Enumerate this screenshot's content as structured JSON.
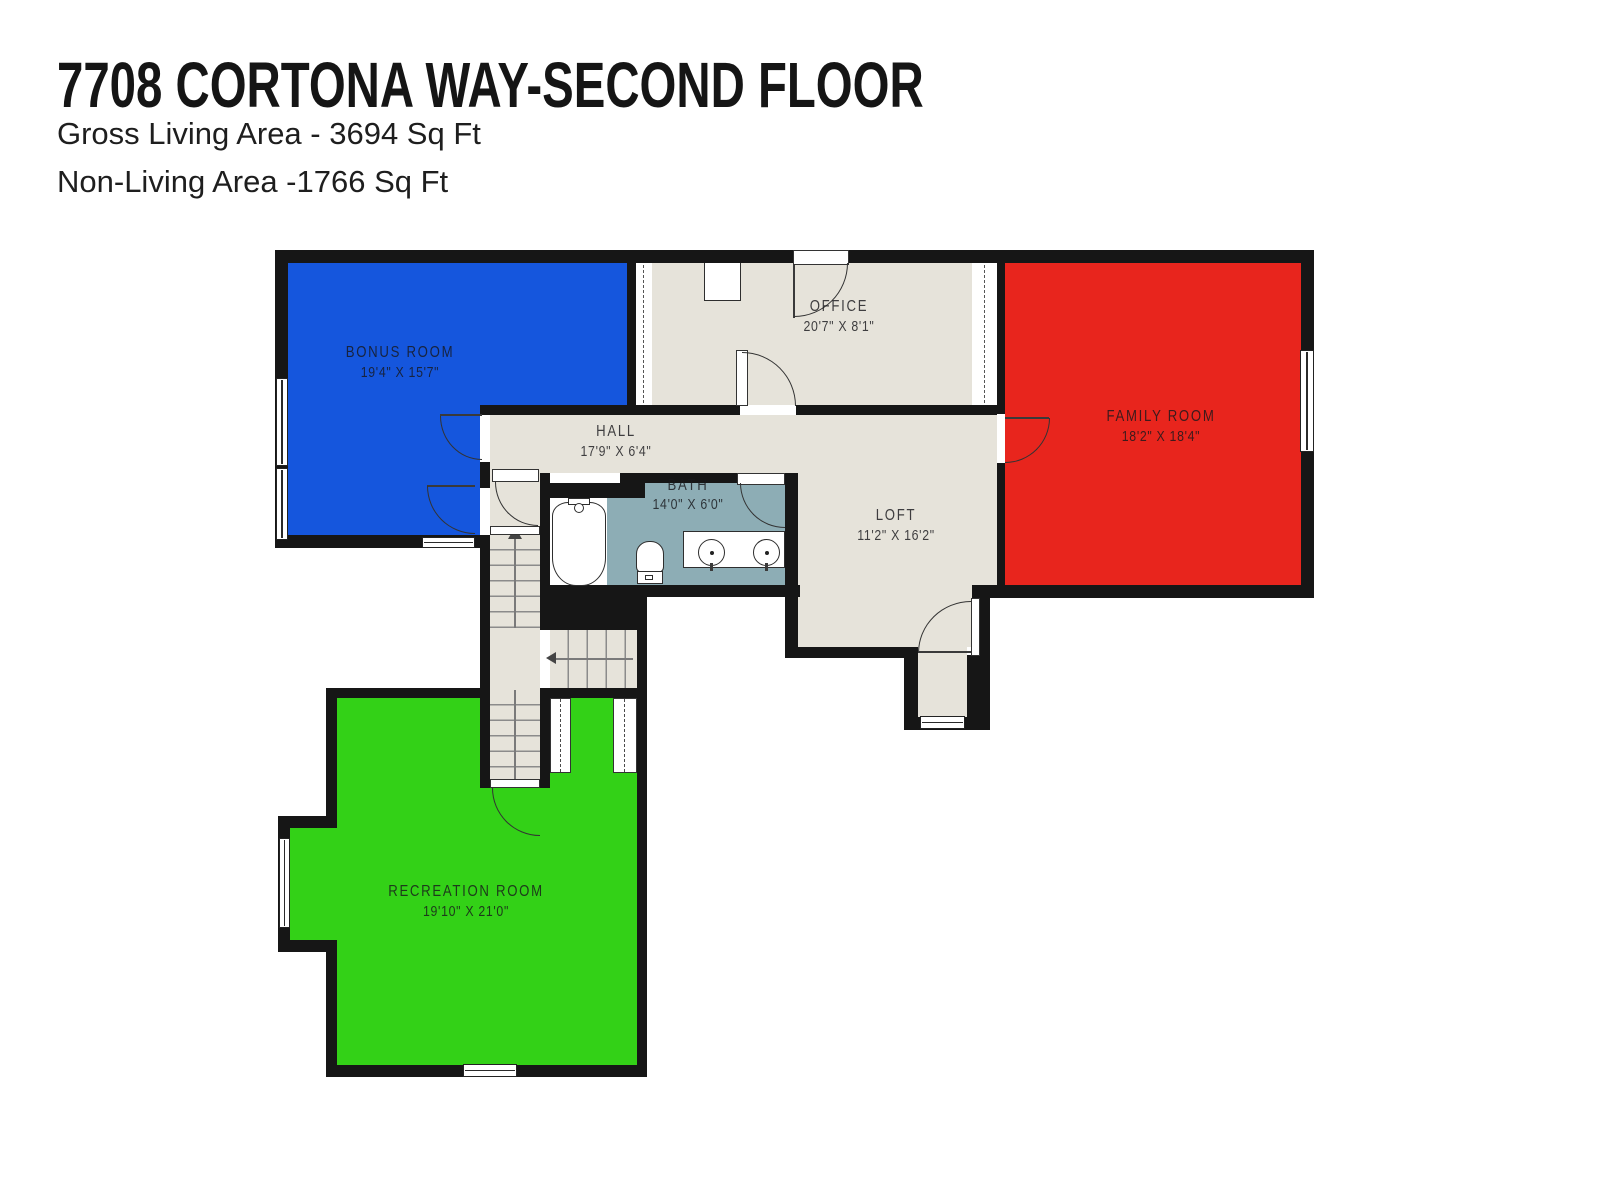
{
  "header": {
    "title": "7708 CORTONA WAY-SECOND FLOOR",
    "gross_living": "Gross Living Area - 3694 Sq Ft",
    "non_living": "Non-Living Area -1766 Sq Ft"
  },
  "rooms": [
    {
      "id": "bonus",
      "name": "BONUS ROOM",
      "dims": "19'4\" X 15'7\"",
      "color": "#1556dd"
    },
    {
      "id": "office",
      "name": "OFFICE",
      "dims": "20'7\" X 8'1\"",
      "color": "#e6e3da"
    },
    {
      "id": "family",
      "name": "FAMILY ROOM",
      "dims": "18'2\" X 18'4\"",
      "color": "#e8251d"
    },
    {
      "id": "hall",
      "name": "HALL",
      "dims": "17'9\" X 6'4\"",
      "color": "#e6e3da"
    },
    {
      "id": "bath",
      "name": "BATH",
      "dims": "14'0\" X 6'0\"",
      "color": "#8dadb5"
    },
    {
      "id": "loft",
      "name": "LOFT",
      "dims": "11'2\" X 16'2\"",
      "color": "#e6e3da"
    },
    {
      "id": "rec",
      "name": "RECREATION ROOM",
      "dims": "19'10\" X 21'0\"",
      "color": "#33d117"
    }
  ],
  "colors": {
    "wall": "#161616",
    "floor_beige": "#e6e3da",
    "bonus_blue": "#1556dd",
    "family_red": "#e8251d",
    "rec_green": "#33d117",
    "bath_teal": "#8dadb5",
    "background": "#ffffff"
  }
}
